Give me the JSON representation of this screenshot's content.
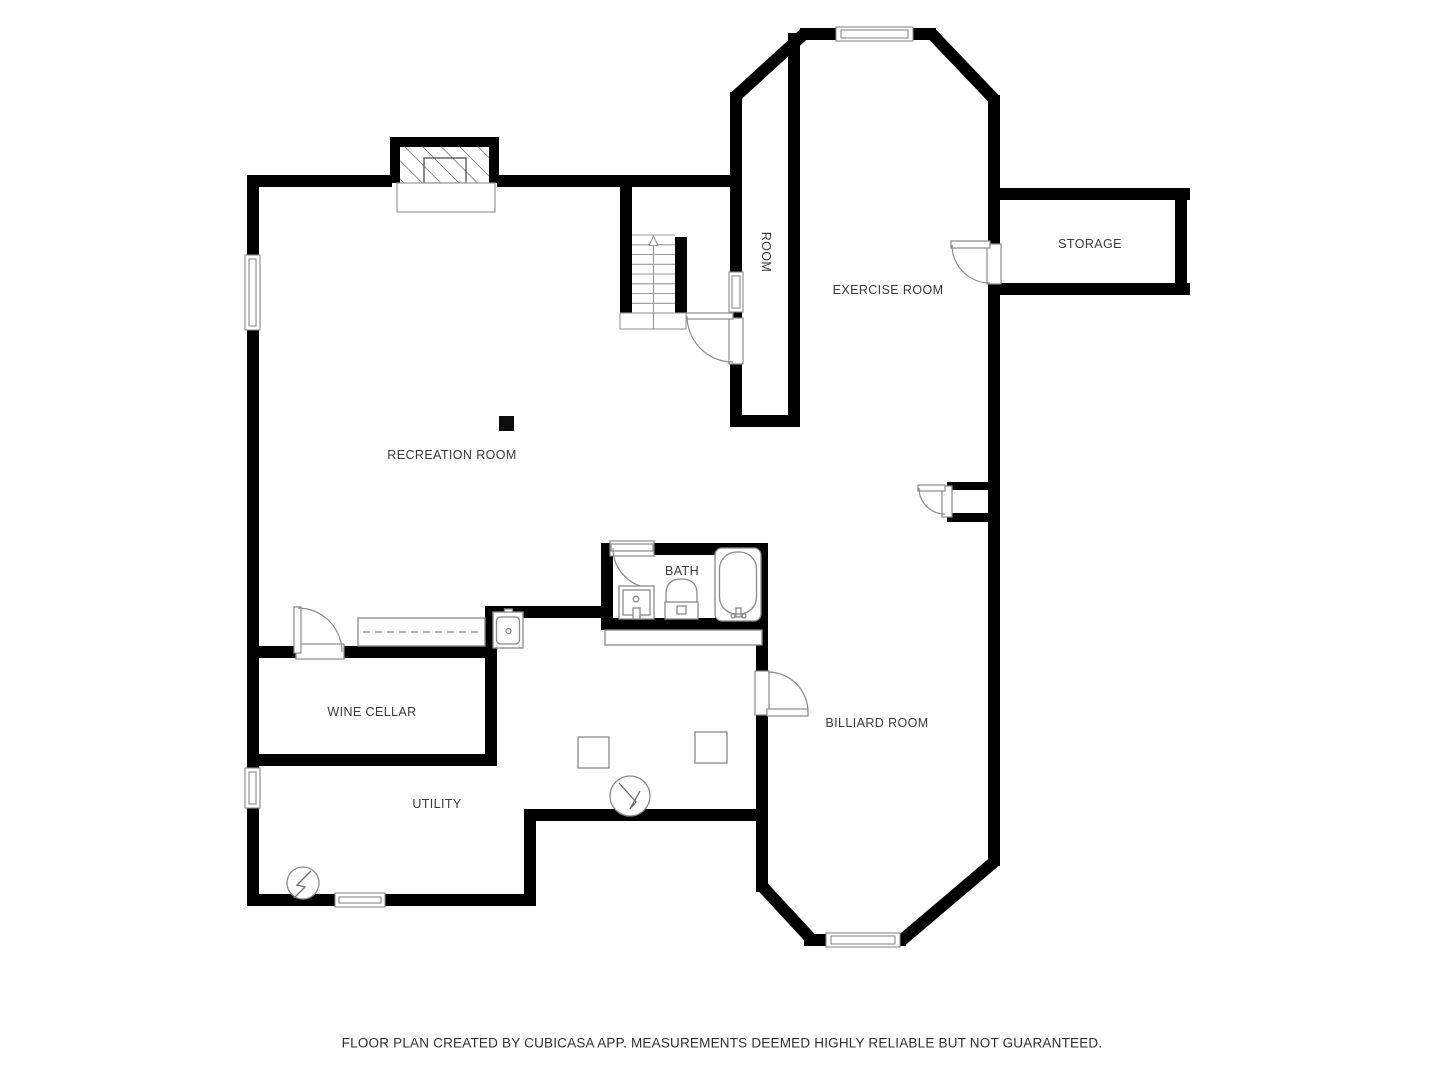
{
  "labels": {
    "recreation": "RECREATION ROOM",
    "room": "ROOM",
    "exercise": "EXERCISE ROOM",
    "storage": "STORAGE",
    "bath": "BATH",
    "wine_cellar": "WINE CELLAR",
    "utility": "UTILITY",
    "billiard": "BILLIARD ROOM"
  },
  "footer": {
    "text": "FLOOR PLAN CREATED BY CUBICASA APP. MEASUREMENTS DEEMED HIGHLY RELIABLE BUT NOT GUARANTEED."
  },
  "colors": {
    "wall": "#000000",
    "fixture_line": "#8a8a8a",
    "text": "#3a3a3a",
    "background": "#ffffff"
  }
}
